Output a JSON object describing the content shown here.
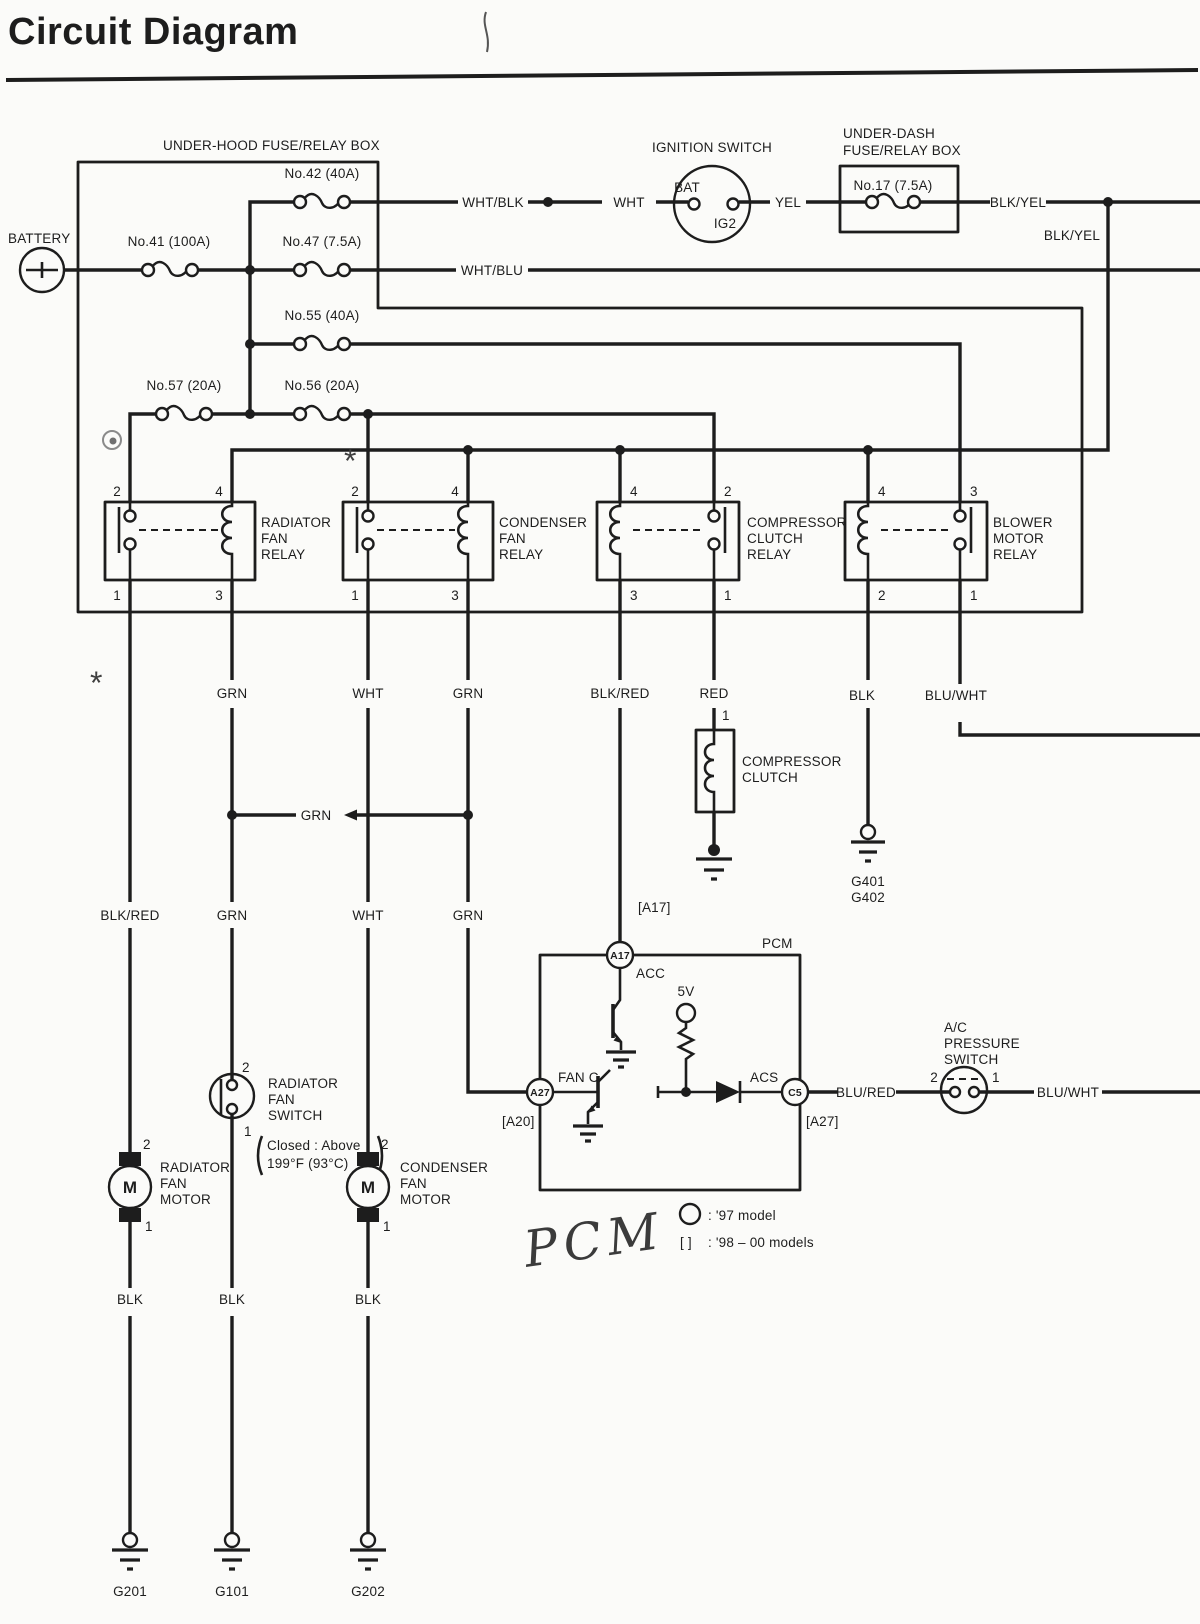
{
  "title": "Circuit Diagram",
  "colors": {
    "ink": "#1d1d1d",
    "paper": "#fbfbf9"
  },
  "labels": {
    "under_hood_box": "UNDER-HOOD FUSE/RELAY BOX",
    "under_dash_box_line1": "UNDER-DASH",
    "under_dash_box_line2": "FUSE/RELAY BOX",
    "battery": "BATTERY",
    "ignition_switch": "IGNITION SWITCH",
    "ignition_bat": "BAT",
    "ignition_ig2": "IG2",
    "pcm": "PCM",
    "pcm_handwritten": "PCM"
  },
  "fuses": {
    "no41": "No.41 (100A)",
    "no42": "No.42 (40A)",
    "no47": "No.47 (7.5A)",
    "no55": "No.55 (40A)",
    "no56": "No.56 (20A)",
    "no57": "No.57 (20A)",
    "no17": "No.17 (7.5A)"
  },
  "wire_labels": {
    "wht_blk": "WHT/BLK",
    "wht": "WHT",
    "yel": "YEL",
    "blk_yel": "BLK/YEL",
    "wht_blu": "WHT/BLU",
    "grn": "GRN",
    "blk_red": "BLK/RED",
    "red": "RED",
    "blk": "BLK",
    "blu_wht": "BLU/WHT",
    "blu_red": "BLU/RED"
  },
  "relays": [
    {
      "line1": "RADIATOR",
      "line2": "FAN",
      "line3": "RELAY",
      "pin_tl": "2",
      "pin_tr": "4",
      "pin_bl": "1",
      "pin_br": "3"
    },
    {
      "line1": "CONDENSER",
      "line2": "FAN",
      "line3": "RELAY",
      "pin_tl": "2",
      "pin_tr": "4",
      "pin_bl": "1",
      "pin_br": "3"
    },
    {
      "line1": "COMPRESSOR",
      "line2": "CLUTCH",
      "line3": "RELAY",
      "pin_tl": "4",
      "pin_tr": "2",
      "pin_bl": "3",
      "pin_br": "1"
    },
    {
      "line1": "BLOWER",
      "line2": "MOTOR",
      "line3": "RELAY",
      "pin_tl": "4",
      "pin_tr": "3",
      "pin_bl": "2",
      "pin_br": "1"
    }
  ],
  "compressor_clutch": {
    "line1": "COMPRESSOR",
    "line2": "CLUTCH",
    "pin": "1"
  },
  "radiator_fan_switch": {
    "line1": "RADIATOR",
    "line2": "FAN",
    "line3": "SWITCH",
    "note1": "Closed : Above",
    "note2": "199°F (93°C)",
    "pin_top": "2",
    "pin_bottom": "1"
  },
  "radiator_fan_motor": {
    "line1": "RADIATOR",
    "line2": "FAN",
    "line3": "MOTOR",
    "m": "M",
    "pin_top": "2",
    "pin_bottom": "1"
  },
  "condenser_fan_motor": {
    "line1": "CONDENSER",
    "line2": "FAN",
    "line3": "MOTOR",
    "m": "M",
    "pin_top": "2",
    "pin_bottom": "1"
  },
  "ac_pressure_switch": {
    "line1": "A/C",
    "line2": "PRESSURE",
    "line3": "SWITCH",
    "pin_left": "2",
    "pin_right": "1"
  },
  "pcm": {
    "a17": "A17",
    "a17_bracket": "[A17]",
    "acc": "ACC",
    "a27": "A27",
    "a20_bracket": "[A20]",
    "fan_c": "FAN C",
    "supply": "5V",
    "acs": "ACS",
    "c5": "C5",
    "c5_bracket": "[A27]"
  },
  "legend": {
    "circle_note": ": '97 model",
    "bracket_symbol": "[ ]",
    "bracket_note": ": '98 – 00 models"
  },
  "grounds": {
    "g201": "G201",
    "g101": "G101",
    "g202": "G202",
    "g401": "G401",
    "g402": "G402"
  },
  "artifacts": {
    "asterisk": "*"
  }
}
